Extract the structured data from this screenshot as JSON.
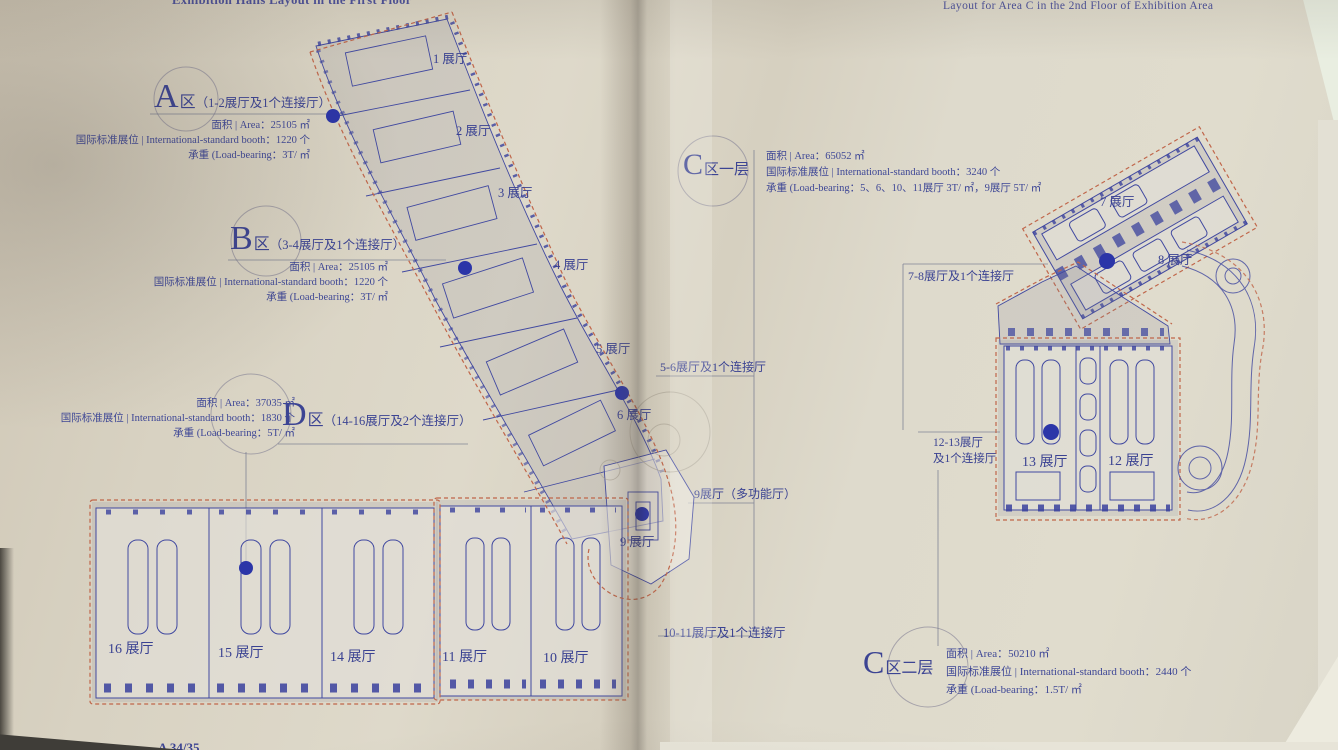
{
  "left": {
    "title": "Exhibition Halls Layout in the First Floor",
    "page_number": "A 34/35",
    "zones": {
      "a": {
        "big": "A",
        "suffix": "区",
        "paren": "（1-2展厅及1个连接厅）",
        "stats": [
          "面积 | Area：25105 ㎡",
          "国际标准展位 | International-standard booth：1220 个",
          "承重 (Load-bearing：3T/ ㎡"
        ]
      },
      "b": {
        "big": "B",
        "suffix": "区",
        "paren": "（3-4展厅及1个连接厅）",
        "stats": [
          "面积 | Area：25105 ㎡",
          "国际标准展位 | International-standard booth：1220 个",
          "承重 (Load-bearing：3T/ ㎡"
        ]
      },
      "d": {
        "big": "D",
        "suffix": "区",
        "paren": "（14-16展厅及2个连接厅）",
        "stats": [
          "面积 | Area：37035 ㎡",
          "国际标准展位 | International-standard booth：1830 个",
          "承重 (Load-bearing：5T/ ㎡"
        ]
      }
    },
    "halls": {
      "h1": "1 展厅",
      "h2": "2 展厅",
      "h3": "3 展厅",
      "h4": "4 展厅",
      "h5": "5 展厅",
      "h6": "6 展厅",
      "h9": "9 展厅",
      "h10": "10 展厅",
      "h11": "11 展厅",
      "h14": "14 展厅",
      "h15": "15 展厅",
      "h16": "16 展厅"
    },
    "callouts": {
      "c56": "5-6展厅及1个连接厅",
      "c9": "9展厅（多功能厅）",
      "c1011": "10-11展厅及1个连接厅"
    }
  },
  "right": {
    "title": "Layout for Area C in the 2nd Floor of Exhibition Area",
    "zones": {
      "c1": {
        "big": "C",
        "suffix": "区一层",
        "stats": [
          "面积 | Area：65052 ㎡",
          "国际标准展位 | International-standard booth：3240 个",
          "承重 (Load-bearing：5、6、10、11展厅 3T/ ㎡，9展厅 5T/ ㎡"
        ]
      },
      "c2": {
        "big": "C",
        "suffix": "区二层",
        "stats": [
          "面积 | Area：50210 ㎡",
          "国际标准展位 | International-standard booth：2440 个",
          "承重 (Load-bearing：1.5T/ ㎡"
        ]
      }
    },
    "halls": {
      "h7": "7 展厅",
      "h8": "8 展厅",
      "h12": "12 展厅",
      "h13": "13 展厅"
    },
    "callouts": {
      "c78": "7-8展厅及1个连接厅",
      "c1213a": "12-13展厅",
      "c1213b": "及1个连接厅"
    }
  },
  "colors": {
    "ink": "#3c4493",
    "plan_line": "#4149a0",
    "boundary_dash": "#c0664a",
    "connector_dot": "#2b35a8",
    "paper": "#d9d3c4"
  }
}
